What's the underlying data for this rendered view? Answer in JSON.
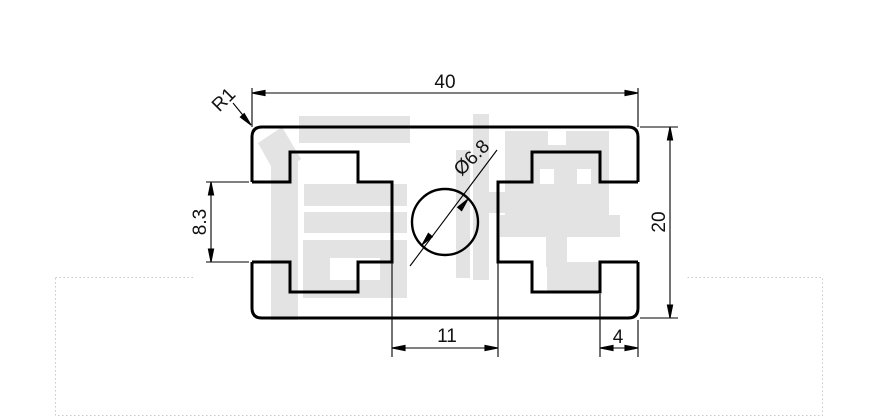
{
  "page": {
    "background": "#ffffff",
    "dotted_border_color": "#c8c8c8"
  },
  "drawing": {
    "line_color": "#000000",
    "watermark": {
      "text": "信牌",
      "color": "#e3e3e3"
    },
    "dimensions": {
      "overall_width": "40",
      "overall_height": "20",
      "slot_opening": "8.3",
      "center_channel_width": "11",
      "edge_flange_width": "4",
      "corner_radius": "R1",
      "center_hole_diameter": "Ø6.8"
    }
  }
}
